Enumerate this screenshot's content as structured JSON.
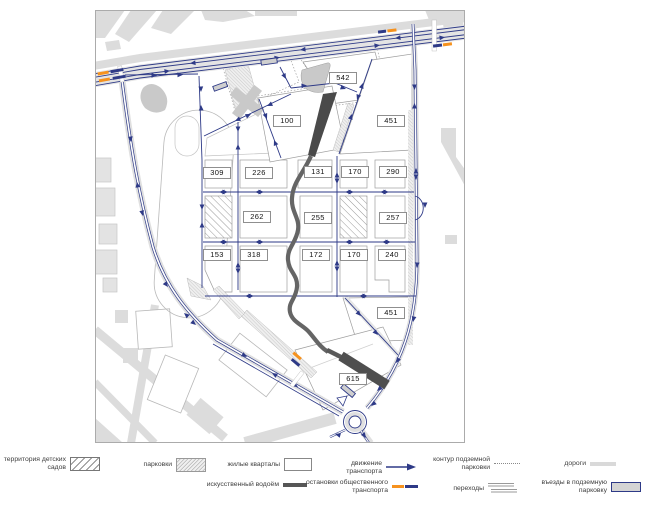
{
  "map": {
    "block_labels": [
      "542",
      "100",
      "451",
      "309",
      "226",
      "131",
      "170",
      "290",
      "262",
      "255",
      "257",
      "153",
      "318",
      "172",
      "170",
      "240",
      "451",
      "615"
    ]
  },
  "legend": {
    "row1": [
      {
        "label": "территория детских садов"
      },
      {
        "label": "парковки"
      },
      {
        "label": "жилые кварталы"
      },
      {
        "label": "движение транспорта"
      },
      {
        "label": "контур подземной парковки"
      },
      {
        "label": "дороги"
      }
    ],
    "row2": [
      {
        "label": "искусственный водоём"
      },
      {
        "label": "остановки общественного транспорта"
      },
      {
        "label": "переходы"
      },
      {
        "label": "въезды в подземную парковку"
      }
    ]
  },
  "colors": {
    "road_blue": "#2e3a87",
    "stop_orange": "#f6921e",
    "water_gray": "#565656",
    "context_gray": "#dcdcdc"
  }
}
